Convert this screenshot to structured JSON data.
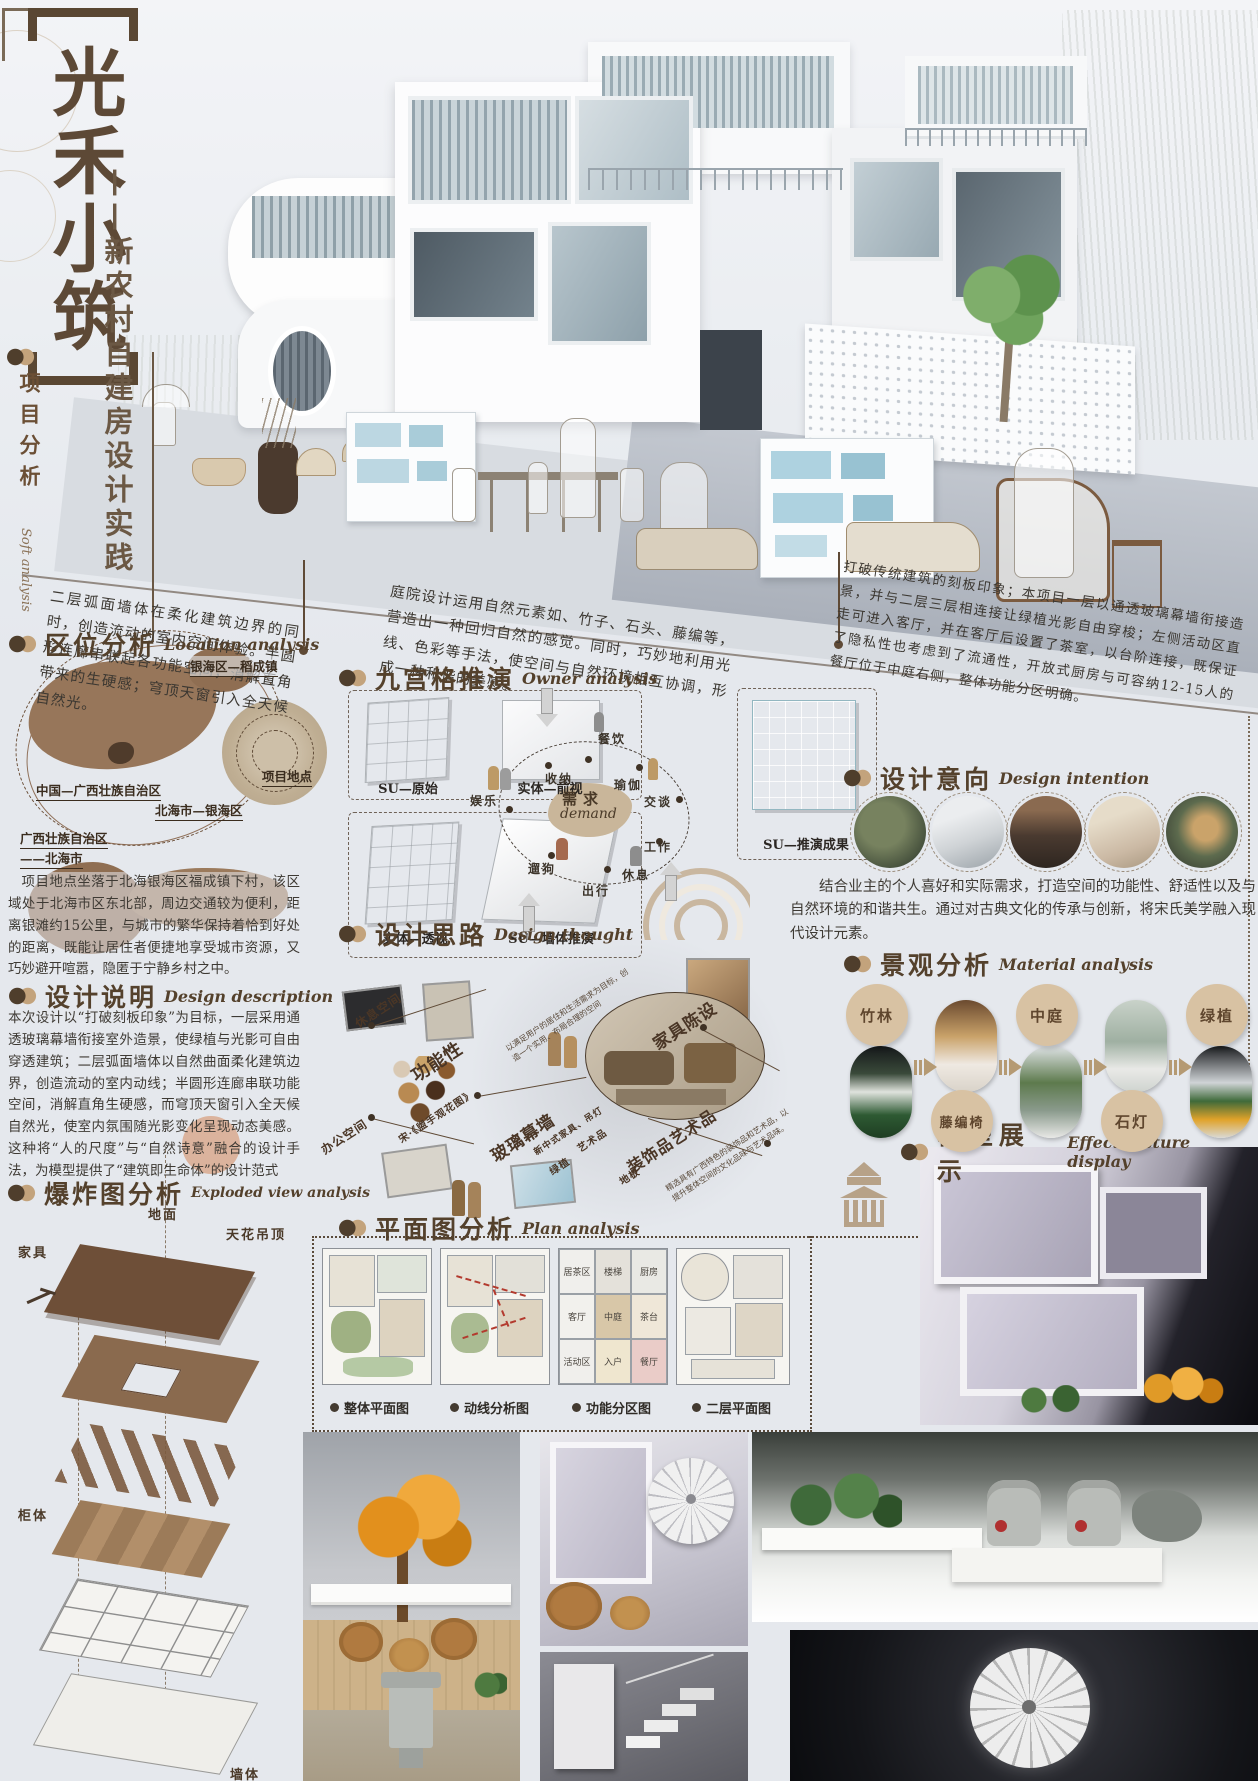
{
  "poster": {
    "title": "光禾小筑",
    "subtitle": "——新农村自建房设计实践",
    "side_label": "项目分析",
    "side_label_en": "Soft analysis"
  },
  "tilted": {
    "left": "二层弧面墙体在柔化建筑边界的同时，创造流动的室内空间体验。半圆形连廊串联起各功能空间，消解直角带来的生硬感；穹顶天窗引入全天候自然光。",
    "middle": "庭院设计运用自然元素如、竹子、石头、藤编等，营造出一种回归自然的感觉。同时，巧妙地利用光线、色彩等手法，使空间与自然环境相互协调，形成一种和谐的美感。",
    "right": "打破传统建筑的刻板印象；本项目一层以通透玻璃幕墙衔接造景，并与二层三层相连接让绿植光影自由穿梭；左侧活动区直走可进入客厅，并在客厅后设置了茶室，以台阶连接，既保证了隐私性也考虑到了流通性，开放式厨房与可容纳12-15人的餐厅位于中庭右侧，整体功能分区明确。"
  },
  "location": {
    "heading_cn": "区位分析",
    "heading_en": "Location analysis",
    "labels": {
      "china": "中国—广西壮族自治区",
      "town": "银海区—稻成镇",
      "site": "项目地点",
      "district": "北海市—银海区",
      "city_line1": "广西壮族自治区",
      "city_line2": "——北海市"
    },
    "body": "项目地点坐落于北海银海区福成镇下村，该区域处于北海市区东北部，周边交通较为便利，距离银滩约15公里，与城市的繁华保持着恰到好处的距离，既能让居住者便捷地享受城市资源，又巧妙避开喧嚣，隐匿于宁静乡村之中。"
  },
  "design_desc": {
    "heading_cn": "设计说明",
    "heading_en": "Design description",
    "body": "本次设计以“打破刻板印象”为目标，一层采用通透玻璃幕墙衔接室外造景，使绿植与光影可自由穿透建筑；二层弧面墙体以自然曲面柔化建筑边界，创造流动的室内动线；半圆形连廊串联功能空间，消解直角生硬感，而穹顶天窗引入全天候自然光，使室内氛围随光影变化呈现动态美感。这种将“人的尺度”与“自然诗意”融合的设计手法，为模型提供了“建筑即生命体”的设计范式"
  },
  "owner": {
    "heading_cn": "九宫格推演",
    "heading_en": "Owner analysis",
    "cube_labels": [
      "SU—原始",
      "实体—前视",
      "实体—透视",
      "SU—墙体推演",
      "SU—推演成果"
    ],
    "demand_cn": "需求",
    "demand_en": "demand",
    "needs": [
      "餐饮",
      "收纳",
      "瑜伽",
      "交谈",
      "娱乐",
      "遛狗",
      "出行",
      "休息",
      "工作"
    ]
  },
  "thought": {
    "heading_cn": "设计思路",
    "heading_en": "Design thought",
    "nodes": [
      "休息空间",
      "办公空间",
      "功能性",
      "玻璃幕墙",
      "家具陈设",
      "装饰品艺术品",
      "新中式家具、吊灯",
      "艺术品",
      "绿植",
      "地板",
      "宋·《盥手观花图》"
    ],
    "notes": [
      "以满足用户的居住和生活需求为目标，创造一个实用、布局合理的空间",
      "精选具有广西特色的装饰品和艺术品，以提升整体空间的文化品味与艺术品味。"
    ]
  },
  "intention": {
    "heading_cn": "设计意向",
    "heading_en": "Design intention",
    "body": "结合业主的个人喜好和实际需求，打造空间的功能性、舒适性以及与自然环境的和谐共生。通过对古典文化的传承与创新，将宋氏美学融入现代设计元素。"
  },
  "material": {
    "heading_cn": "景观分析",
    "heading_en": "Material analysis",
    "items": [
      "竹林",
      "藤编椅",
      "中庭",
      "石灯",
      "绿植"
    ]
  },
  "exploded": {
    "heading_cn": "爆炸图分析",
    "heading_en": "Exploded view analysis",
    "labels": [
      "地面",
      "天花吊顶",
      "家具",
      "柜体",
      "墙体"
    ]
  },
  "plan": {
    "heading_cn": "平面图分析",
    "heading_en": "Plan analysis",
    "captions": [
      "整体平面图",
      "动线分析图",
      "功能分区图",
      "二层平面图"
    ],
    "rooms": [
      "居茶区",
      "楼梯",
      "厨房",
      "客厅",
      "中庭",
      "茶台",
      "活动区",
      "入户",
      "餐厅"
    ]
  },
  "model": {
    "heading_cn": "模型展示",
    "heading_en": "Effect picture display"
  }
}
